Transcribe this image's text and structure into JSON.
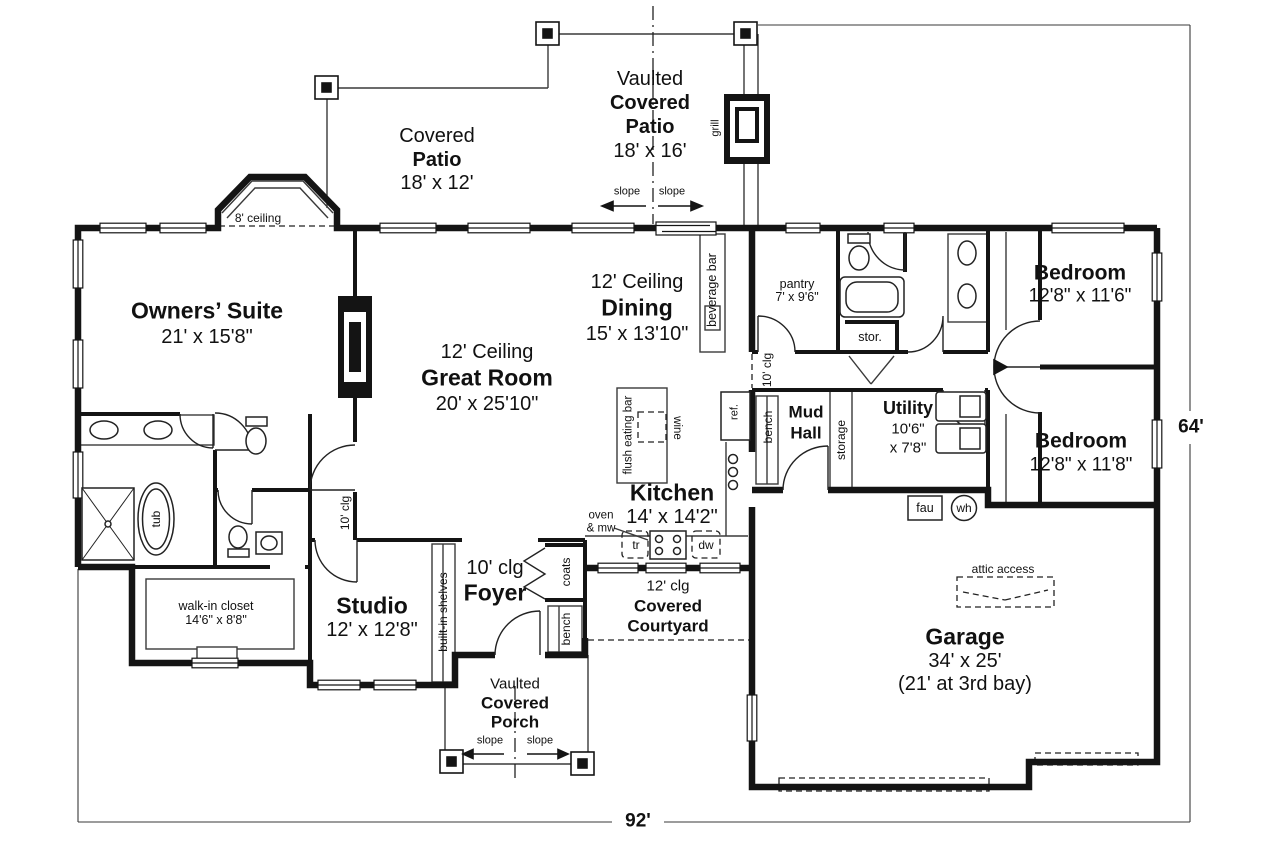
{
  "plan": {
    "rooms": {
      "owners_suite": {
        "name": "Owners’ Suite",
        "dims": "21' x 15'8\""
      },
      "great_room": {
        "ceiling": "12' Ceiling",
        "name": "Great Room",
        "dims": "20' x 25'10\""
      },
      "dining": {
        "ceiling": "12' Ceiling",
        "name": "Dining",
        "dims": "15' x 13'10\""
      },
      "kitchen": {
        "name": "Kitchen",
        "dims": "14' x 14'2\""
      },
      "pantry": {
        "name": "pantry",
        "dims": "7' x 9'6\""
      },
      "bedroom_upper": {
        "name": "Bedroom",
        "dims": "12'8\" x 11'6\""
      },
      "bedroom_lower": {
        "name": "Bedroom",
        "dims": "12'8\" x 11'8\""
      },
      "mud_hall": {
        "line1": "Mud",
        "line2": "Hall"
      },
      "utility": {
        "name": "Utility",
        "dims_line1": "10'6\"",
        "dims_line2": "x 7'8\""
      },
      "garage": {
        "name": "Garage",
        "dims": "34' x 25'",
        "note": "(21' at 3rd bay)"
      },
      "studio": {
        "name": "Studio",
        "dims": "12' x 12'8\""
      },
      "foyer": {
        "ceiling": "10' clg",
        "name": "Foyer"
      },
      "walk_in_closet": {
        "name": "walk-in closet",
        "dims": "14'6\" x 8'8\""
      }
    },
    "outdoor": {
      "covered_patio": {
        "line1": "Covered",
        "line2": "Patio",
        "dims": "18' x 12'"
      },
      "vaulted_patio": {
        "line1": "Vaulted",
        "line2": "Covered",
        "line3": "Patio",
        "dims": "18' x 16'"
      },
      "courtyard": {
        "ceiling": "12' clg",
        "line1": "Covered",
        "line2": "Courtyard"
      },
      "porch": {
        "line1": "Vaulted",
        "line2": "Covered",
        "line3": "Porch"
      },
      "slope": "slope",
      "ceiling_8": "8' ceiling"
    },
    "fixtures": {
      "grill": "grill",
      "beverage_bar": "beverage bar",
      "ten_clg": "10' clg",
      "ref": "ref.",
      "bench": "bench",
      "storage": "storage",
      "stor": "stor.",
      "flush_eating_bar": "flush eating bar",
      "wine": "wine",
      "tub": "tub",
      "oven_line1": "oven",
      "oven_line2": "& mw",
      "tr": "tr",
      "dw": "dw",
      "fau": "fau",
      "wh": "wh",
      "attic": "attic access",
      "built_in_shelves": "built-in shelves",
      "coats": "coats"
    },
    "dimensions": {
      "width": "92'",
      "depth": "64'"
    }
  }
}
